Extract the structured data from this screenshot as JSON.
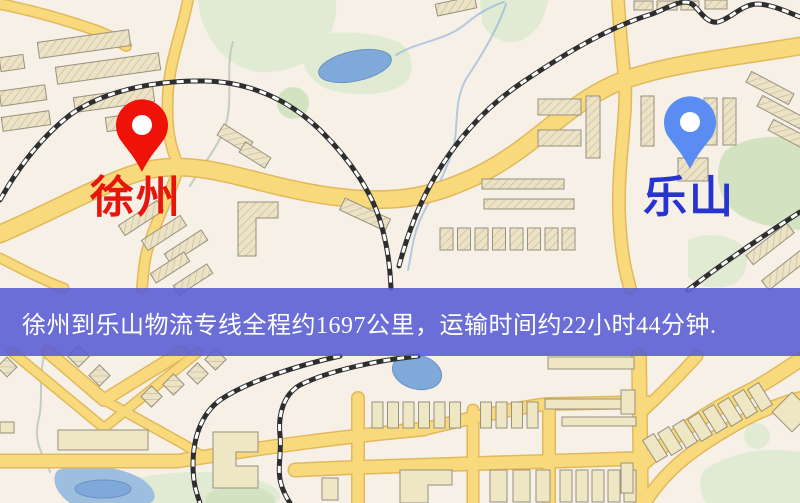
{
  "map": {
    "markers": {
      "origin": {
        "label": "徐州",
        "pin_color": "#ee1208",
        "label_color": "#e8150d"
      },
      "destination": {
        "label": "乐山",
        "pin_color": "#5b8cf2",
        "label_color": "#2834cf"
      }
    },
    "banner": {
      "text": "徐州到乐山物流专线全程约1697公里，运输时间约22小时44分钟.",
      "origin": "徐州",
      "destination": "乐山",
      "distance_km": "1697",
      "duration": "22小时44分钟"
    }
  },
  "theme": {
    "map_background": "#f6f0e7",
    "road_fill": "#f8da7c",
    "road_casing": "#e2b85c",
    "building_fill": "#ece2c6",
    "building_hatch": "#cabf9e",
    "building_line": "#97917f",
    "building_fill_plain": "#efe6c4",
    "green_light": "#e1ebd4",
    "green_mid": "#d3e3c2",
    "water": "#7ea9d8",
    "water_light": "#9dbede",
    "railway": "#2e2e2e",
    "banner_background": "rgba(88,91,213,0.88)",
    "banner_text": "#ffffff",
    "origin_pin": "#ee1208",
    "origin_label": "#e8150d",
    "destination_pin": "#5b8cf2",
    "destination_label": "#2834cf"
  }
}
